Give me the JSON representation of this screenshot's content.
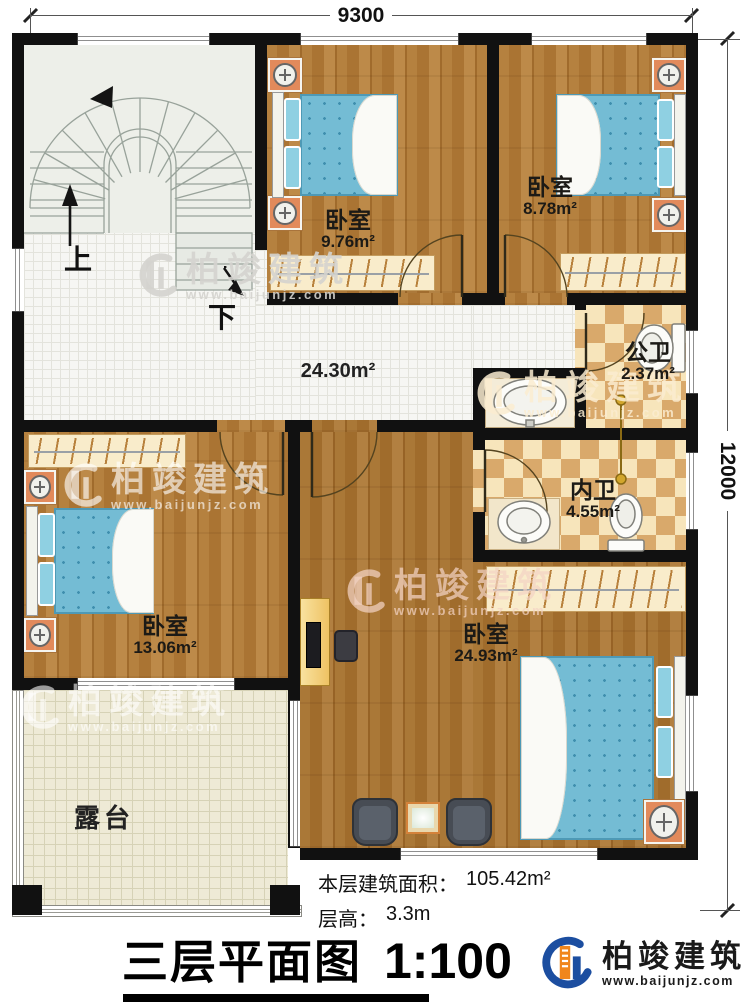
{
  "plan": {
    "dimensions": {
      "width_label": "9300",
      "height_label": "12000"
    },
    "stairs": {
      "up": "上",
      "down": "下"
    },
    "rooms": {
      "bedroom_top_mid": {
        "name": "卧室",
        "area": "9.76m²"
      },
      "bedroom_top_right": {
        "name": "卧室",
        "area": "8.78m²"
      },
      "public_bath": {
        "name": "公卫",
        "area": "2.37m²"
      },
      "private_bath": {
        "name": "内卫",
        "area": "4.55m²"
      },
      "bedroom_left": {
        "name": "卧室",
        "area": "13.06m²"
      },
      "bedroom_main": {
        "name": "卧室",
        "area": "24.93m²"
      },
      "hall": {
        "area": "24.30m²"
      },
      "terrace": {
        "name": "露台"
      }
    }
  },
  "footer": {
    "floor_area_label": "本层建筑面积：",
    "floor_area_value": "105.42m²",
    "floor_height_label": "层高：",
    "floor_height_value": "3.3m",
    "title": "三层平面图",
    "scale": "1:100"
  },
  "brand": {
    "name": "柏竣建筑",
    "url": "www.baijunjz.com",
    "blue": "#1c4ea0",
    "orange": "#f0861c"
  },
  "watermark": {
    "text": "柏竣建筑",
    "url": "www.baijunjz.com"
  }
}
